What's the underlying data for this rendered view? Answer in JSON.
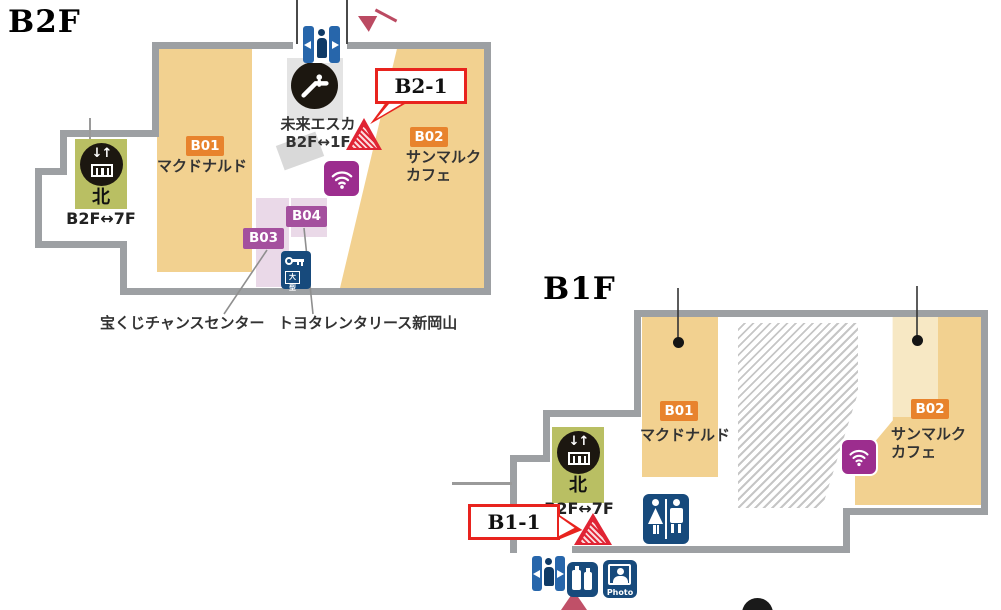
{
  "colors": {
    "wall_gray": "#9da0a3",
    "area_tan": "#f2d190",
    "area_tan_light": "#f7e8c4",
    "area_pink": "#ead9e8",
    "label_orange": "#e8832d",
    "label_purple": "#a4509e",
    "callout_red": "#e8231e",
    "marker_red": "#e02434",
    "arrow_pink": "#bb4a62",
    "icon_navy": "#174a7c",
    "gate_blue": "#2766ab",
    "wifi_magenta": "#9c2d8e",
    "elevator_olive": "#b9bf63"
  },
  "icons": {
    "elevator_arrows": "↓↑"
  },
  "b2f": {
    "title": "B2F",
    "callout": "B2-1",
    "shops": {
      "b01": {
        "code": "B01",
        "name": "マクドナルド"
      },
      "b02": {
        "code": "B02",
        "name_line1": "サンマルク",
        "name_line2": "カフェ"
      },
      "b03": {
        "code": "B03",
        "name": "宝くじチャンスセンター"
      },
      "b04": {
        "code": "B04",
        "name": "トヨタレンタリース新岡山"
      }
    },
    "escalator": {
      "name": "未来エスカ",
      "floors": "B2F↔1F"
    },
    "elevator": {
      "name": "北",
      "floors": "B2F↔7F"
    },
    "locker": {
      "size_label": "大型"
    }
  },
  "b1f": {
    "title": "B1F",
    "callout": "B1-1",
    "shops": {
      "b01": {
        "code": "B01",
        "name": "マクドナルド"
      },
      "b02": {
        "code": "B02",
        "name_line1": "サンマルク",
        "name_line2": "カフェ"
      }
    },
    "elevator": {
      "name": "北",
      "floors": "B2F↔7F"
    },
    "photo_booth": {
      "label": "Photo"
    }
  }
}
